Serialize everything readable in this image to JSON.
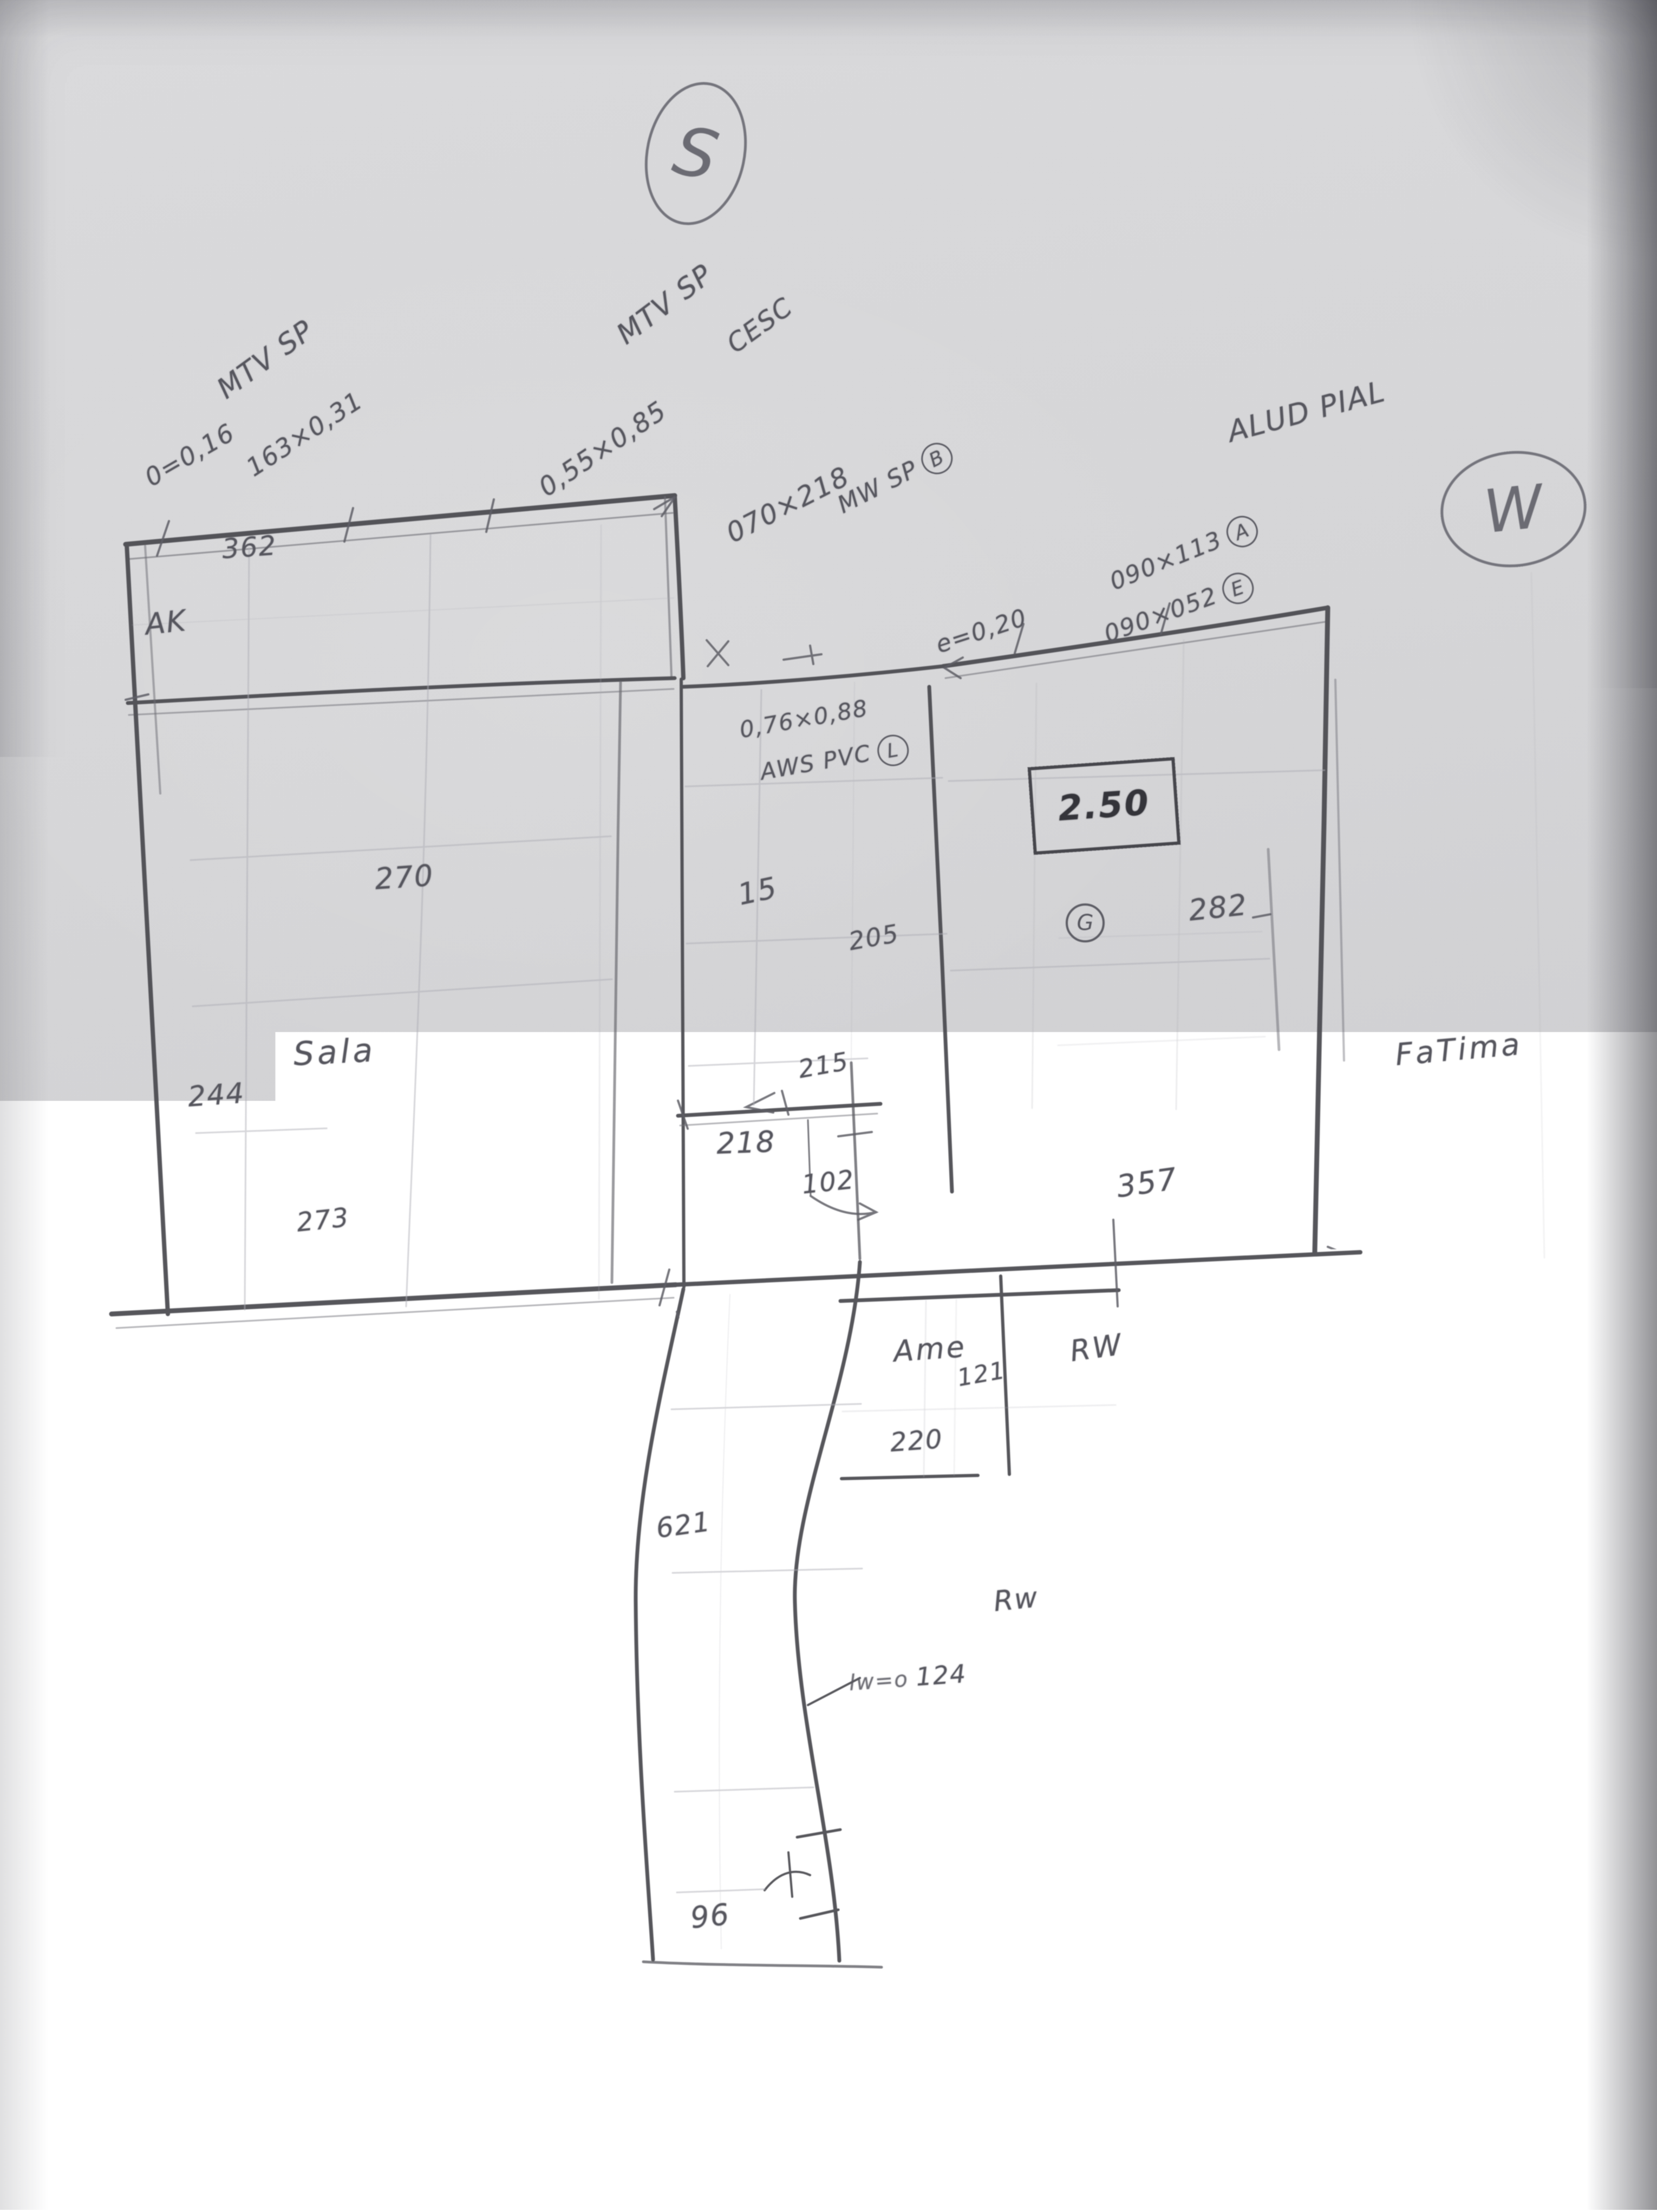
{
  "sketch": {
    "compass": {
      "south": "S",
      "west": "W"
    },
    "openings": {
      "mtv1_title": "MTV SP",
      "mtv1_spec1": "0=0,16",
      "mtv1_spec2": "163×0,31",
      "mtv2_title": "MTV SP",
      "mtv2_spec": "0,55×0,85",
      "mtv2_note": "CESC",
      "door_size": "070×218",
      "door_label": "MW SP",
      "door_tag": "B",
      "wall_thickness": "e=0,20",
      "alu_title": "ALUD PIAL",
      "alu_spec_a": "090×113",
      "alu_tag_a": "A",
      "alu_spec_e": "090×052",
      "alu_tag_e": "E",
      "pvc_size": "0,76×0,88",
      "pvc_label": "AWS PVC",
      "pvc_tag": "L",
      "boxed_value": "2.50",
      "circled_g": "G"
    },
    "rooms": {
      "sala": "Sala",
      "ak": "AK",
      "ame": "Ame",
      "fatima": "FaTima",
      "rw_right": "RW",
      "rw_lower": "Rw"
    },
    "dims": {
      "d362": "362",
      "d270": "270",
      "d15": "15",
      "d205": "205",
      "d215": "215",
      "d218": "218",
      "d102": "102",
      "d244": "244",
      "d273": "273",
      "d282": "282",
      "d357": "357",
      "d121": "121",
      "d220": "220",
      "d621": "621",
      "d124_prefix": "lw=o",
      "d124": "124",
      "d96": "96"
    }
  }
}
